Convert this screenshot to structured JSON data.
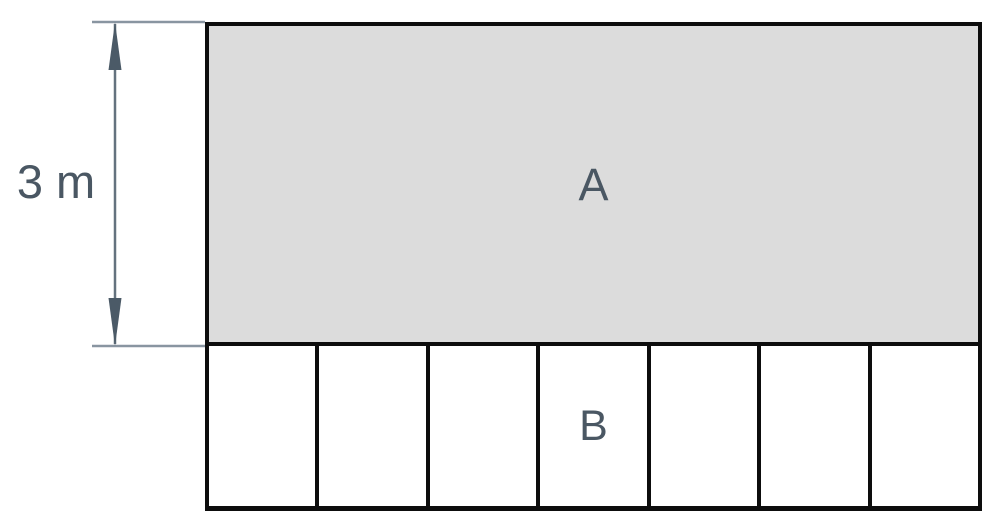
{
  "diagram": {
    "type": "geometry-figure",
    "dimension_label": "3 m",
    "region_a_label": "A",
    "bottom_cells": [
      "",
      "",
      "",
      "B",
      "",
      "",
      ""
    ],
    "bottom_cell_count": 7,
    "colors": {
      "region_a_fill": "#dcdcdc",
      "outline": "#0d0d0d",
      "label_text": "#4a5763",
      "dimension_line": "#64727e",
      "extension_line": "#8995a1",
      "arrowhead": "#4b5a67"
    }
  }
}
